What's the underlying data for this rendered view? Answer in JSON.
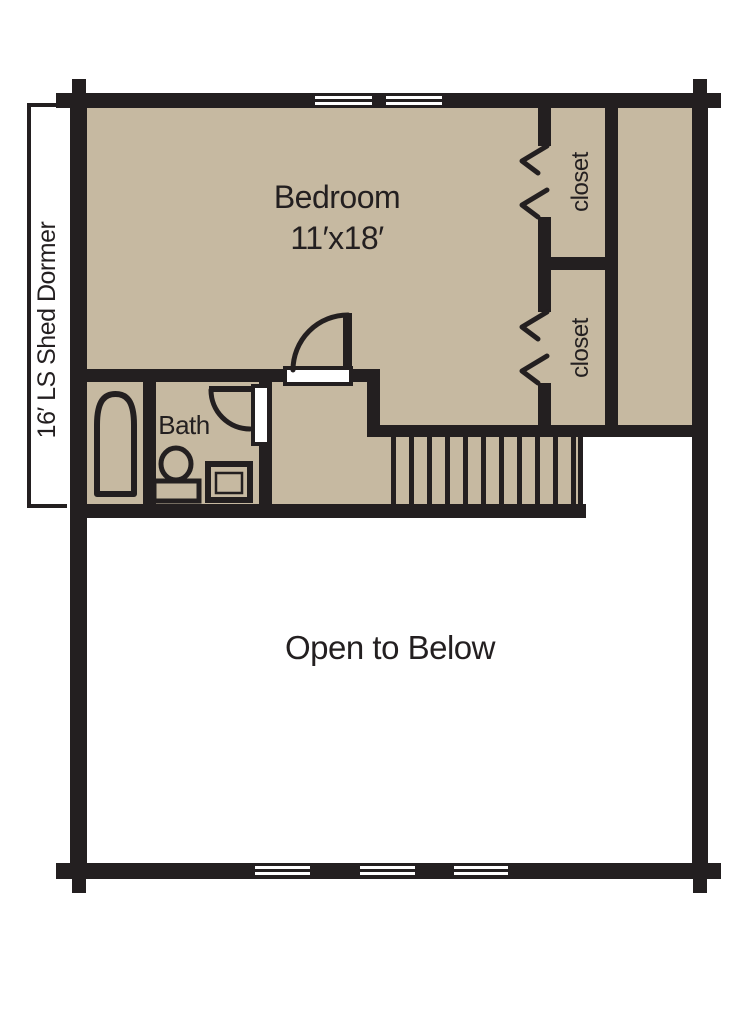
{
  "plan": {
    "dormer_label": "16′ LS Shed Dormer",
    "bedroom": {
      "name": "Bedroom",
      "size": "11′x18′"
    },
    "bath": {
      "name": "Bath"
    },
    "closet_top": {
      "name": "closet"
    },
    "closet_bottom": {
      "name": "closet"
    },
    "open_to_below_label": "Open to Below",
    "colors": {
      "wall": "#231f20",
      "floor_fill": "#c6b9a1",
      "window_fill": "#ffffff",
      "background": "#ffffff"
    }
  }
}
